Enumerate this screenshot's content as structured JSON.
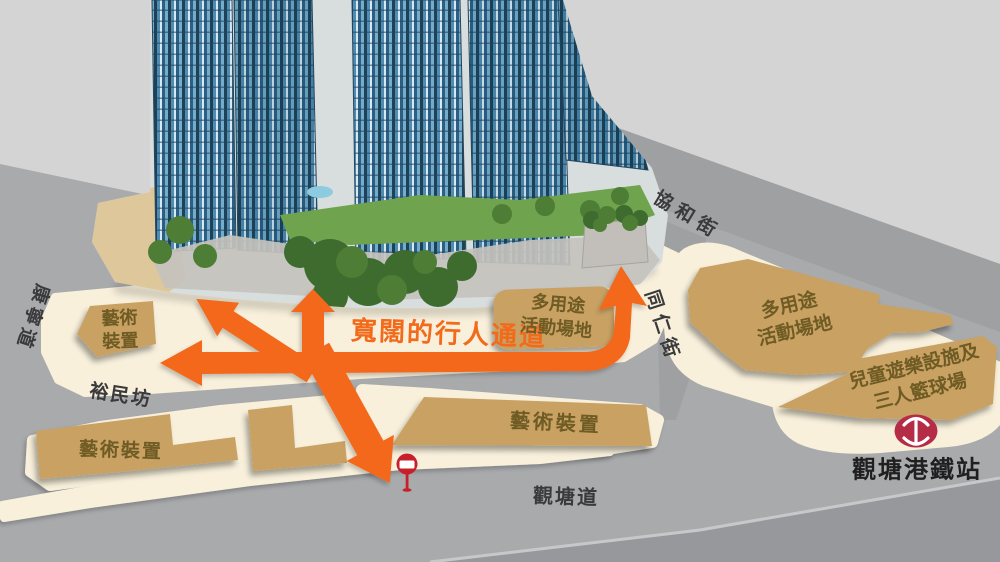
{
  "streets": {
    "hong_ning_road": "康寧道",
    "hip_wo_street": "協和街",
    "tung_yan_street": "同仁街",
    "yue_man_square": "裕民坊",
    "kwun_tong_road": "觀塘道"
  },
  "walkway": {
    "label": "寬闊的行人通道"
  },
  "features": {
    "art_upper_left": {
      "line1": "藝術",
      "line2": "裝置"
    },
    "venue_center": {
      "line1": "多用途",
      "line2": "活動場地"
    },
    "art_lower_left": {
      "label": "藝術裝置"
    },
    "art_lower_center": {
      "label": "藝術裝置"
    },
    "venue_right": {
      "line1": "多用途",
      "line2": "活動場地"
    },
    "kids_playground_right": {
      "line1": "兒童遊樂設施及",
      "line2": "三人籃球場"
    }
  },
  "station": {
    "label": "觀塘港鐵站"
  },
  "icons": {
    "mtr_logo": "mtr-logo",
    "no_entry_sign": "no-entry-sign"
  },
  "colors": {
    "arrow_orange": "#F4671F",
    "walkway_text_orange": "#F26A1B",
    "plaza_cream": "#F8F0DB",
    "feature_tan": "#C8A164",
    "feature_text_brown": "#6F5B24",
    "street_gray": "#A9AAAC",
    "street_band_gray": "#9EA0A2",
    "light_gray": "#D4D4D5",
    "mtr_red": "#B52C47",
    "sign_red": "#C8202B",
    "label_dark": "#3A3A3C"
  }
}
